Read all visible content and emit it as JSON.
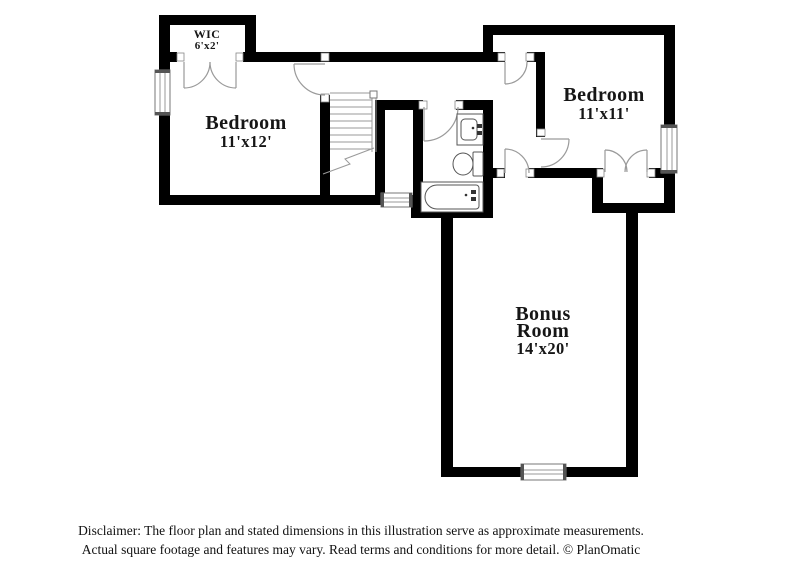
{
  "floorplan": {
    "rooms": {
      "wic": {
        "name": "WIC",
        "dims": "6'x2'"
      },
      "bedroom_left": {
        "name": "Bedroom",
        "dims": "11'x12'"
      },
      "bedroom_right": {
        "name": "Bedroom",
        "dims": "11'x11'"
      },
      "bonus": {
        "name_line1": "Bonus",
        "name_line2": "Room",
        "dims": "14'x20'"
      }
    },
    "colors": {
      "wall": "#000000",
      "door_line": "#9a9a9a",
      "fixture_line": "#555555"
    },
    "disclaimer": {
      "line1": "Disclaimer: The floor plan and stated dimensions in this illustration serve as approximate measurements.",
      "line2": "Actual square footage and features may vary. Read terms and conditions for more detail. © PlanOmatic"
    }
  }
}
